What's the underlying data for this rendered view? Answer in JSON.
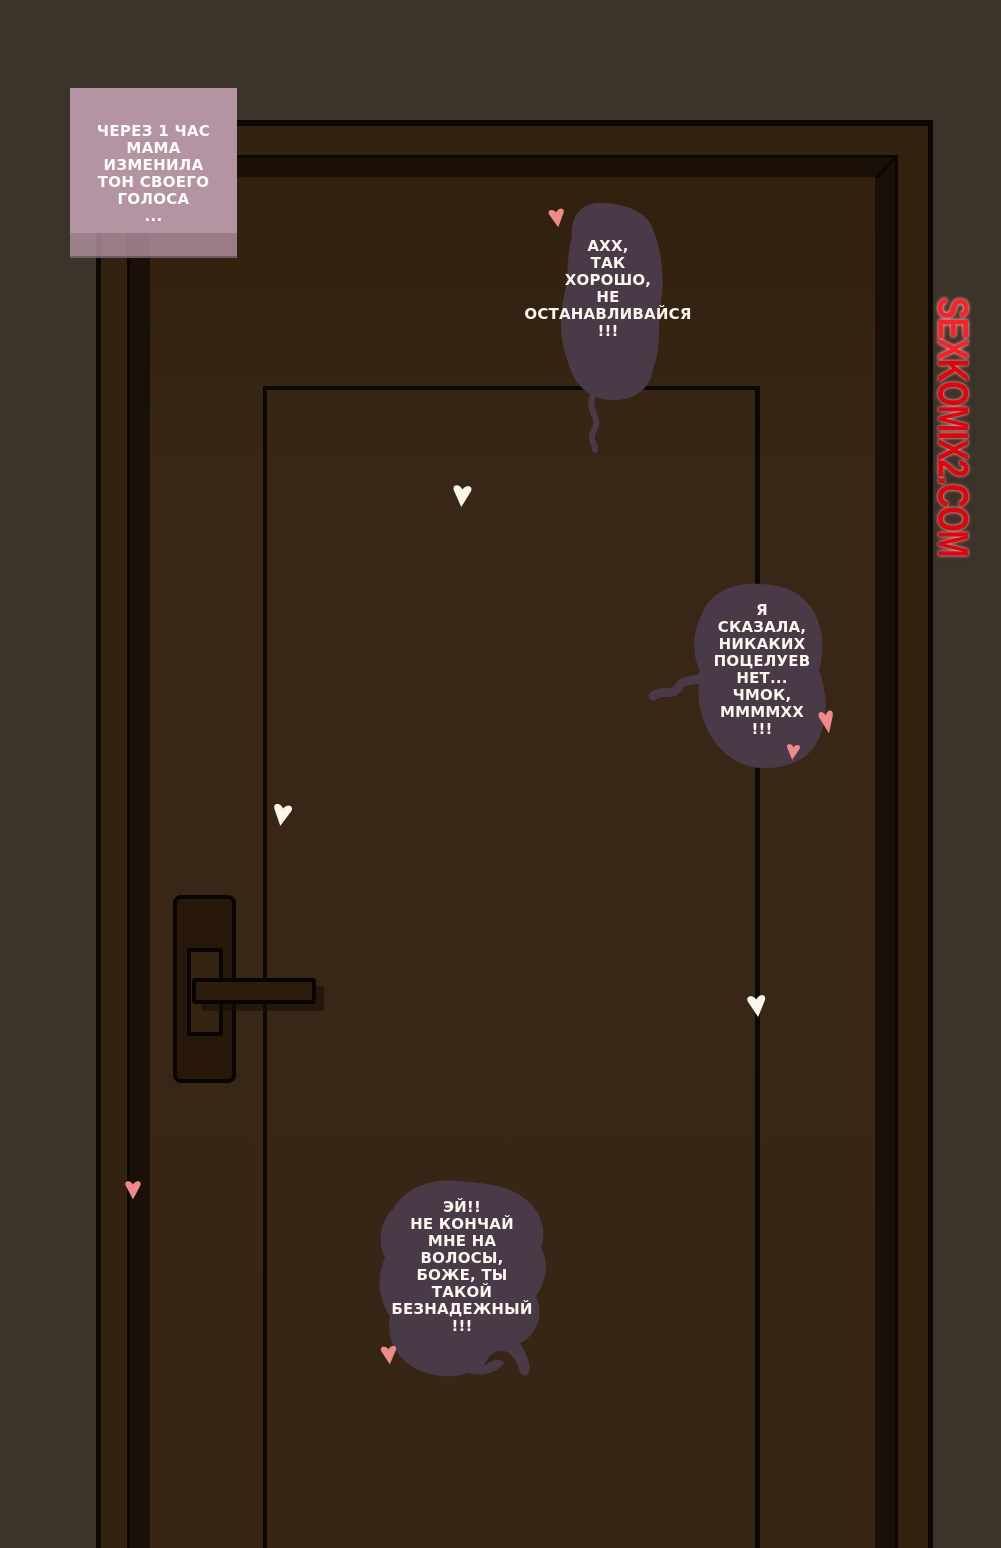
{
  "page": {
    "type": "comic-page",
    "background_color": "#3a342b"
  },
  "caption": {
    "text": "ЧЕРЕЗ 1 ЧАС\nМАМА\nИЗМЕНИЛА\nТОН СВОЕГО\nГОЛОСА\n...",
    "background_color": "#b494a3",
    "text_color": "#fdfcfa"
  },
  "speech_bubbles": [
    {
      "text": "АХХ,\nТАК\nХОРОШО,\nНЕ\nОСТАНАВЛИВАЙСЯ\n!!!"
    },
    {
      "text": "Я\nСКАЗАЛА,\nНИКАКИХ\nПОЦЕЛУЕВ\nНЕТ...\nЧМОК,\nММММХХ\n!!!"
    },
    {
      "text": "ЭЙ!!\nНЕ КОНЧАЙ\nМНЕ НА\nВОЛОСЫ,\nБОЖЕ, ТЫ\nТАКОЙ\nБЕЗНАДЕЖНЫЙ\n!!!"
    }
  ],
  "colors": {
    "bubble_fill": "#4a3947",
    "bubble_text": "#fbf6ee",
    "door_frame": "#33220f",
    "door_slab": "#372615",
    "door_recess": "#1a1007",
    "outline": "#0e0804",
    "heart_pink": "#ef8a8c",
    "heart_white": "#faf6ec",
    "watermark_red": "#e8101a"
  },
  "watermark": {
    "part1": "SEX",
    "part2": "KOMIX2.COM"
  }
}
